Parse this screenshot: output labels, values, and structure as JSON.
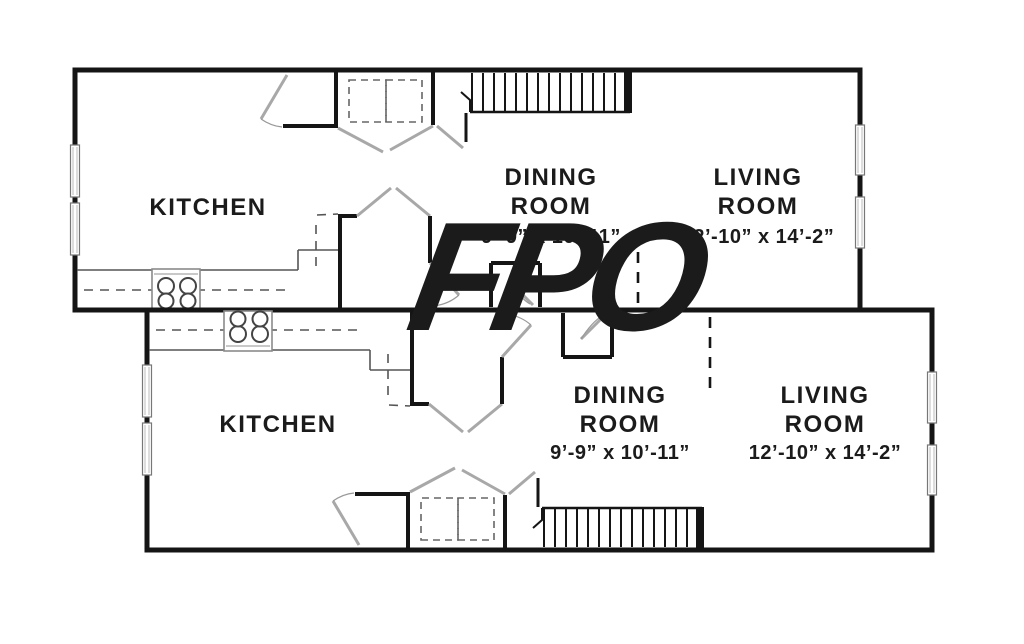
{
  "watermark": {
    "text": "FPO",
    "color": "#E32A8D"
  },
  "plan": {
    "background": "#ffffff",
    "wall_color": "#151515",
    "units": [
      {
        "id": "upper-unit",
        "kitchen": {
          "name": "KITCHEN"
        },
        "dining": {
          "name_line1": "DINING",
          "name_line2": "ROOM",
          "dims": "9’-9” x 10’-11”"
        },
        "living": {
          "name_line1": "LIVING",
          "name_line2": "ROOM",
          "dims": "12’-10” x 14’-2”"
        }
      },
      {
        "id": "lower-unit",
        "kitchen": {
          "name": "KITCHEN"
        },
        "dining": {
          "name_line1": "DINING",
          "name_line2": "ROOM",
          "dims": "9’-9” x 10’-11”"
        },
        "living": {
          "name_line1": "LIVING",
          "name_line2": "ROOM",
          "dims": "12’-10” x 14’-2”"
        }
      }
    ]
  }
}
